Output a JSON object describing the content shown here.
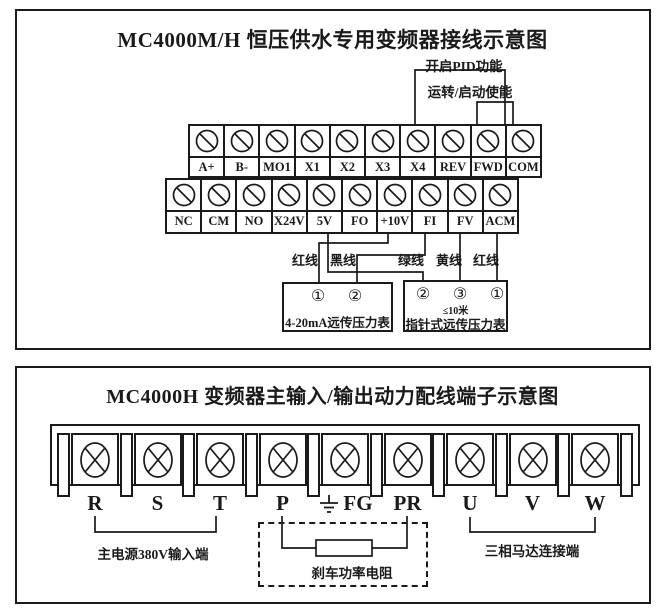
{
  "panel1": {
    "title": "MC4000M/H 恒压供水专用变频器接线示意图",
    "annotations": {
      "pid": "开启PID功能",
      "run": "运转/启动使能"
    },
    "terminal_row1": [
      "A+",
      "B-",
      "MO1",
      "X1",
      "X2",
      "X3",
      "X4",
      "REV",
      "FWD",
      "COM"
    ],
    "terminal_row2": [
      "NC",
      "CM",
      "NO",
      "X24V",
      "5V",
      "FO",
      "+10V",
      "FI",
      "FV",
      "ACM"
    ],
    "wire_labels": [
      "红线",
      "黑线",
      "绿线",
      "黄线",
      "红线"
    ],
    "gauge1": {
      "terminals": [
        "①",
        "②"
      ],
      "label": "4-20mA远传压力表"
    },
    "gauge2": {
      "terminals": [
        "②",
        "③",
        "①"
      ],
      "note": "≤10米",
      "label": "指针式远传压力表"
    },
    "connections": [
      {
        "wire": "红线",
        "from": "+10V",
        "to": "4-20mA远传压力表 ①"
      },
      {
        "wire": "黑线",
        "from": "FI",
        "to": "4-20mA远传压力表 ②"
      },
      {
        "wire": "绿线",
        "from": "5V",
        "to": "指针式远传压力表 ②"
      },
      {
        "wire": "黄线",
        "from": "FV",
        "to": "指针式远传压力表 ③"
      },
      {
        "wire": "红线",
        "from": "ACM",
        "to": "指针式远传压力表 ①"
      },
      {
        "bracket": "开启PID功能",
        "from": "X4",
        "to": "COM"
      },
      {
        "bracket": "运转/启动使能",
        "from": "FWD",
        "to": "COM"
      }
    ]
  },
  "panel2": {
    "title": "MC4000H 变频器主输入/输出动力配线端子示意图",
    "terminals": [
      "R",
      "S",
      "T",
      "P",
      "FG",
      "PR",
      "U",
      "V",
      "W"
    ],
    "ground_terminal": "FG",
    "labels": {
      "input": "主电源380V输入端",
      "brake": "刹车功率电阻",
      "motor": "三相马达连接端"
    }
  }
}
